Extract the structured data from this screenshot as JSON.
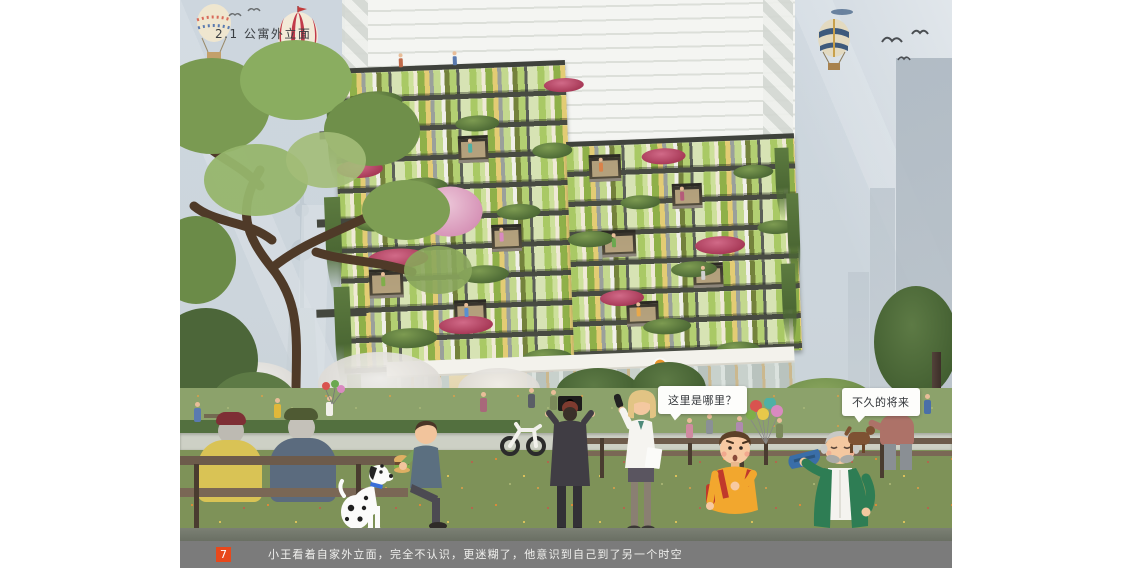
{
  "page": {
    "title": "2.1 公寓外立面",
    "page_number": "7",
    "caption": "小王看着自家外立面，完全不认识，更迷糊了，他意识到自己到了另一个时空"
  },
  "bubbles": {
    "boy": "这里是哪里？",
    "elder": "不久的将来"
  },
  "signs": {
    "bank": "招商银行"
  },
  "colors": {
    "accent": "#E8481B",
    "caption_bar": "#7B7B7B",
    "sky": "#CCD5DD",
    "facade_green": "#9CC25A",
    "facade_yellow": "#E3CC74",
    "slab": "#45483F",
    "grass": "#7E9258",
    "bubble_bg": "#FDFDFB"
  }
}
